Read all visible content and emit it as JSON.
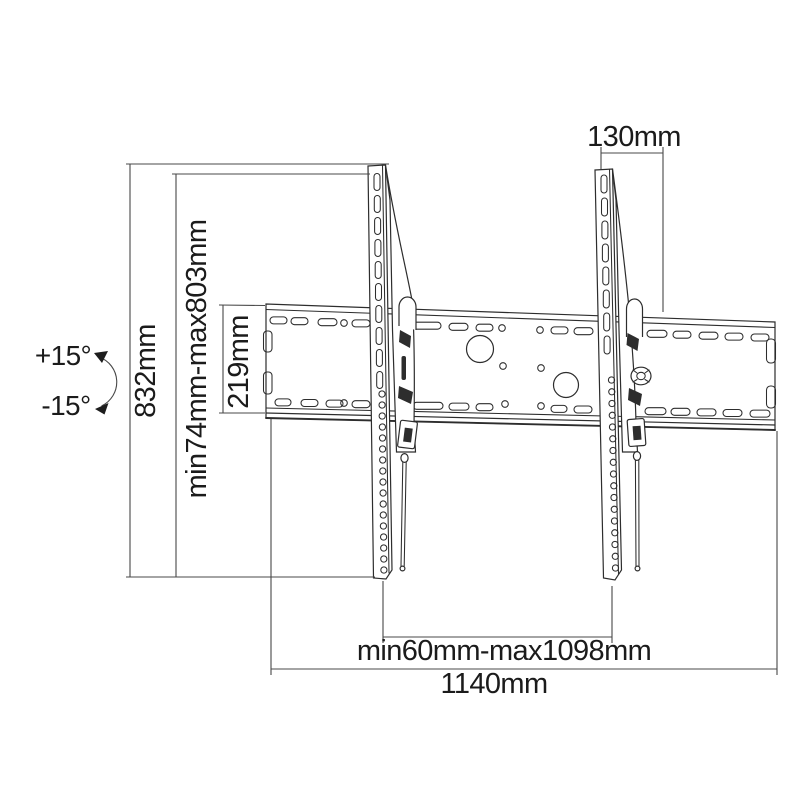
{
  "labels": {
    "offset_130": "130mm",
    "height_832": "832mm",
    "height_range": "min74mm-max803mm",
    "plate_height_219": "219mm",
    "tilt_plus": "+15°",
    "tilt_minus": "-15°",
    "width_range": "min60mm-max1098mm",
    "width_1140": "1140mm"
  },
  "colors": {
    "line": "#2d2d2d",
    "dimension": "#484848",
    "text": "#1b1b1b",
    "background": "#ffffff"
  }
}
